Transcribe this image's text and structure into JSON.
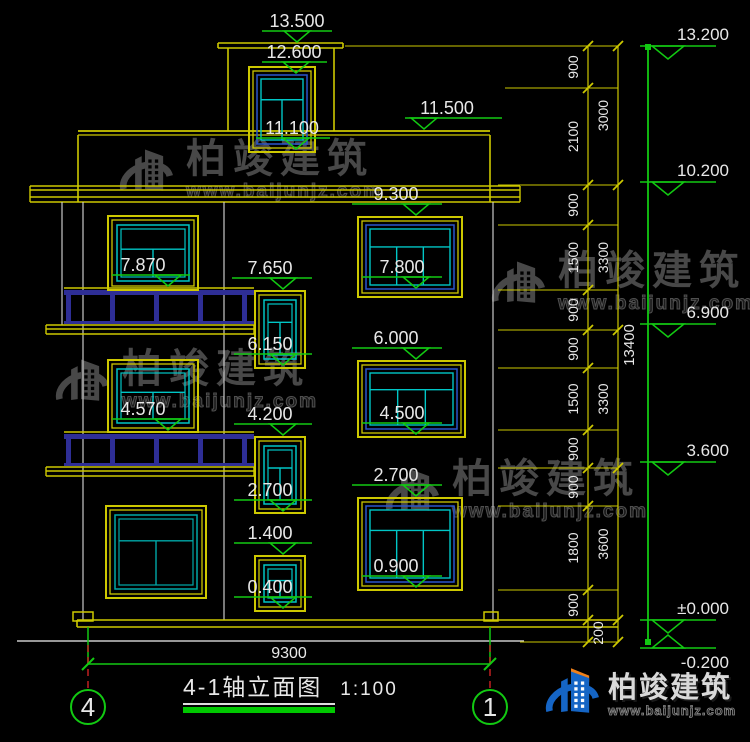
{
  "title_block": {
    "title": "4-1轴立面图",
    "scale": "1:100",
    "axis_left": "4",
    "axis_right": "1"
  },
  "brand": {
    "name": "柏竣建筑",
    "url": "www.baijunjz.com"
  },
  "colors": {
    "background": "#000000",
    "yellow": "#cdc800",
    "cyan": "#00c6c6",
    "teal": "#00a8a8",
    "blue": "#2b55cc",
    "green": "#12c912",
    "gray": "#c9c9c9",
    "navy": "#2e2e96",
    "red": "#cc2222",
    "text": "#e8e8e8",
    "watermark": "#4c4c4c",
    "logo_blue": "#1565c5",
    "logo_orange": "#f08019",
    "title_underline": "#00c800"
  },
  "dimensions": {
    "bottom_total": "9300",
    "right_total": "13400",
    "inner_chain": {
      "x": 588,
      "label_x": 578,
      "boundaries": [
        46,
        88,
        185,
        225,
        290,
        330,
        368,
        430,
        468,
        506,
        590,
        620,
        642
      ],
      "labels": [
        "900",
        "2100",
        "900",
        "1500",
        "900",
        "900",
        "1500",
        "900",
        "900",
        "1800",
        "900",
        ""
      ]
    },
    "middle_chain": {
      "x": 618,
      "label_x": 608,
      "boundaries": [
        46,
        185,
        330,
        468,
        620,
        642
      ],
      "labels": [
        "3000",
        "3300",
        "3300",
        "3600",
        ""
      ]
    },
    "extra_label": {
      "text": "200",
      "x": 603,
      "y": 633
    },
    "extension_lines": [
      [
        345,
        46
      ],
      [
        505,
        88
      ],
      [
        498,
        185
      ],
      [
        498,
        225
      ],
      [
        498,
        290
      ],
      [
        498,
        330
      ],
      [
        498,
        368
      ],
      [
        498,
        430
      ],
      [
        498,
        468
      ],
      [
        498,
        506
      ],
      [
        498,
        590
      ],
      [
        520,
        642
      ]
    ],
    "datum_line": {
      "x": 648,
      "y1": 46,
      "y2": 642
    }
  },
  "elevation_markers": {
    "facade": [
      {
        "label": "13.500",
        "cx": 297,
        "lx1": 262,
        "lx2": 332,
        "tri": 297,
        "tip": 43
      },
      {
        "label": "12.600",
        "cx": 294,
        "lx1": 262,
        "lx2": 327,
        "tri": 296,
        "tip": 74
      },
      {
        "label": "11.100",
        "cx": 292,
        "lx1": 256,
        "lx2": 330,
        "tri": 296,
        "tip": 150
      },
      {
        "label": "11.500",
        "cx": 447,
        "lx1": 405,
        "lx2": 502,
        "tri": 424,
        "tip": 130
      },
      {
        "label": "9.300",
        "cx": 396,
        "lx1": 352,
        "lx2": 442,
        "tri": 416,
        "tip": 216
      },
      {
        "label": "7.800",
        "cx": 402,
        "lx1": 362,
        "lx2": 442,
        "tri": 416,
        "tip": 289
      },
      {
        "label": "7.650",
        "cx": 270,
        "lx1": 232,
        "lx2": 312,
        "tri": 283,
        "tip": 290
      },
      {
        "label": "6.150",
        "cx": 270,
        "lx1": 234,
        "lx2": 312,
        "tri": 283,
        "tip": 366
      },
      {
        "label": "7.870",
        "cx": 143,
        "lx1": 112,
        "lx2": 190,
        "tri": 168,
        "tip": 287
      },
      {
        "label": "4.570",
        "cx": 143,
        "lx1": 112,
        "lx2": 190,
        "tri": 168,
        "tip": 431
      },
      {
        "label": "6.000",
        "cx": 396,
        "lx1": 352,
        "lx2": 442,
        "tri": 416,
        "tip": 360
      },
      {
        "label": "4.500",
        "cx": 402,
        "lx1": 362,
        "lx2": 442,
        "tri": 416,
        "tip": 435
      },
      {
        "label": "4.200",
        "cx": 270,
        "lx1": 234,
        "lx2": 312,
        "tri": 283,
        "tip": 436
      },
      {
        "label": "2.700",
        "cx": 270,
        "lx1": 234,
        "lx2": 312,
        "tri": 283,
        "tip": 512
      },
      {
        "label": "2.700",
        "cx": 396,
        "lx1": 352,
        "lx2": 442,
        "tri": 416,
        "tip": 497
      },
      {
        "label": "1.400",
        "cx": 270,
        "lx1": 234,
        "lx2": 312,
        "tri": 283,
        "tip": 555
      },
      {
        "label": "0.400",
        "cx": 270,
        "lx1": 234,
        "lx2": 312,
        "tri": 283,
        "tip": 609
      },
      {
        "label": "0.900",
        "cx": 396,
        "lx1": 362,
        "lx2": 442,
        "tri": 416,
        "tip": 588
      }
    ],
    "right": [
      {
        "label": "13.200",
        "y": 46,
        "flip": false
      },
      {
        "label": "10.200",
        "y": 182,
        "flip": false
      },
      {
        "label": "6.900",
        "y": 324,
        "flip": false
      },
      {
        "label": "3.600",
        "y": 462,
        "flip": false
      },
      {
        "label": "±0.000",
        "y": 620,
        "flip": false
      },
      {
        "label": "-0.200",
        "y": 648,
        "flip": true
      }
    ]
  },
  "geometry": {
    "lines": [
      [
        218,
        43,
        343,
        43,
        "y",
        1.6
      ],
      [
        218,
        48,
        343,
        48,
        "y",
        1.6
      ],
      [
        218,
        43,
        218,
        48,
        "y",
        1.6
      ],
      [
        343,
        43,
        343,
        48,
        "y",
        1.6
      ],
      [
        228,
        48,
        228,
        131,
        "y",
        1.6
      ],
      [
        334,
        48,
        334,
        131,
        "y",
        1.6
      ],
      [
        78,
        131,
        490,
        131,
        "y",
        1.8
      ],
      [
        78,
        135,
        490,
        135,
        "y",
        1.2
      ],
      [
        78,
        135,
        78,
        202,
        "y",
        1.6
      ],
      [
        490,
        135,
        490,
        202,
        "y",
        1.6
      ],
      [
        30,
        186,
        520,
        186,
        "y",
        1.4
      ],
      [
        30,
        190,
        520,
        190,
        "y",
        1.4
      ],
      [
        30,
        197,
        520,
        197,
        "y",
        1.4
      ],
      [
        30,
        202,
        520,
        202,
        "y",
        1.6
      ],
      [
        30,
        186,
        30,
        202,
        "y",
        1.4
      ],
      [
        520,
        186,
        520,
        202,
        "y",
        1.4
      ],
      [
        83,
        202,
        83,
        620,
        "w",
        1.2
      ],
      [
        62,
        202,
        62,
        325,
        "w",
        1.2
      ],
      [
        224,
        202,
        224,
        620,
        "w",
        1.2
      ],
      [
        493,
        202,
        493,
        620,
        "w",
        1.2
      ],
      [
        77,
        620,
        618,
        620,
        "y",
        1.6
      ],
      [
        77,
        627,
        618,
        627,
        "y",
        1.6
      ],
      [
        77,
        620,
        77,
        627,
        "y",
        1.6
      ],
      [
        17,
        641,
        524,
        641,
        "w",
        1.4
      ],
      [
        88,
        627,
        88,
        664,
        "g",
        1.5
      ],
      [
        490,
        627,
        490,
        664,
        "g",
        1.5
      ],
      [
        88,
        664,
        490,
        664,
        "g",
        1.6
      ],
      [
        88,
        645,
        88,
        702,
        "r",
        1.4
      ],
      [
        490,
        645,
        490,
        702,
        "r",
        1.4
      ]
    ],
    "rects": [
      [
        73,
        612,
        20,
        9,
        "y"
      ],
      [
        484,
        612,
        14,
        9,
        "y"
      ]
    ],
    "balcony_x": {
      "x1": 64,
      "x2": 254,
      "posts": [
        66,
        110,
        154,
        198,
        242
      ],
      "slab_x1": 46,
      "slab_x2": 254
    },
    "balconies": [
      {
        "rail_top": 288,
        "slab_top": 325
      },
      {
        "rail_top": 432,
        "slab_top": 467
      }
    ],
    "windows": [
      {
        "x": 249,
        "y": 67,
        "w": 66,
        "h": 85,
        "style": "cyanblue",
        "transom": 0.34
      },
      {
        "x": 108,
        "y": 216,
        "w": 90,
        "h": 74,
        "style": "cyan",
        "transom": 0.42
      },
      {
        "x": 108,
        "y": 360,
        "w": 90,
        "h": 72,
        "style": "cyan",
        "transom": 0.42
      },
      {
        "x": 106,
        "y": 506,
        "w": 100,
        "h": 92,
        "style": "teal",
        "transom": 0.33
      },
      {
        "x": 255,
        "y": 291,
        "w": 50,
        "h": 77,
        "style": "cyan",
        "transom": 0.36
      },
      {
        "x": 255,
        "y": 437,
        "w": 50,
        "h": 76,
        "style": "cyan",
        "transom": 0.36
      },
      {
        "x": 255,
        "y": 556,
        "w": 50,
        "h": 55,
        "style": "cyan",
        "transom": 0.4
      },
      {
        "x": 358,
        "y": 217,
        "w": 104,
        "h": 80,
        "style": "big",
        "transom": 0.32
      },
      {
        "x": 358,
        "y": 361,
        "w": 107,
        "h": 76,
        "style": "big",
        "transom": 0.32
      },
      {
        "x": 358,
        "y": 498,
        "w": 104,
        "h": 92,
        "style": "big",
        "transom": 0.3
      }
    ]
  },
  "watermarks": [
    {
      "x": 112,
      "y": 138
    },
    {
      "x": 484,
      "y": 250
    },
    {
      "x": 48,
      "y": 348
    },
    {
      "x": 378,
      "y": 458
    }
  ]
}
